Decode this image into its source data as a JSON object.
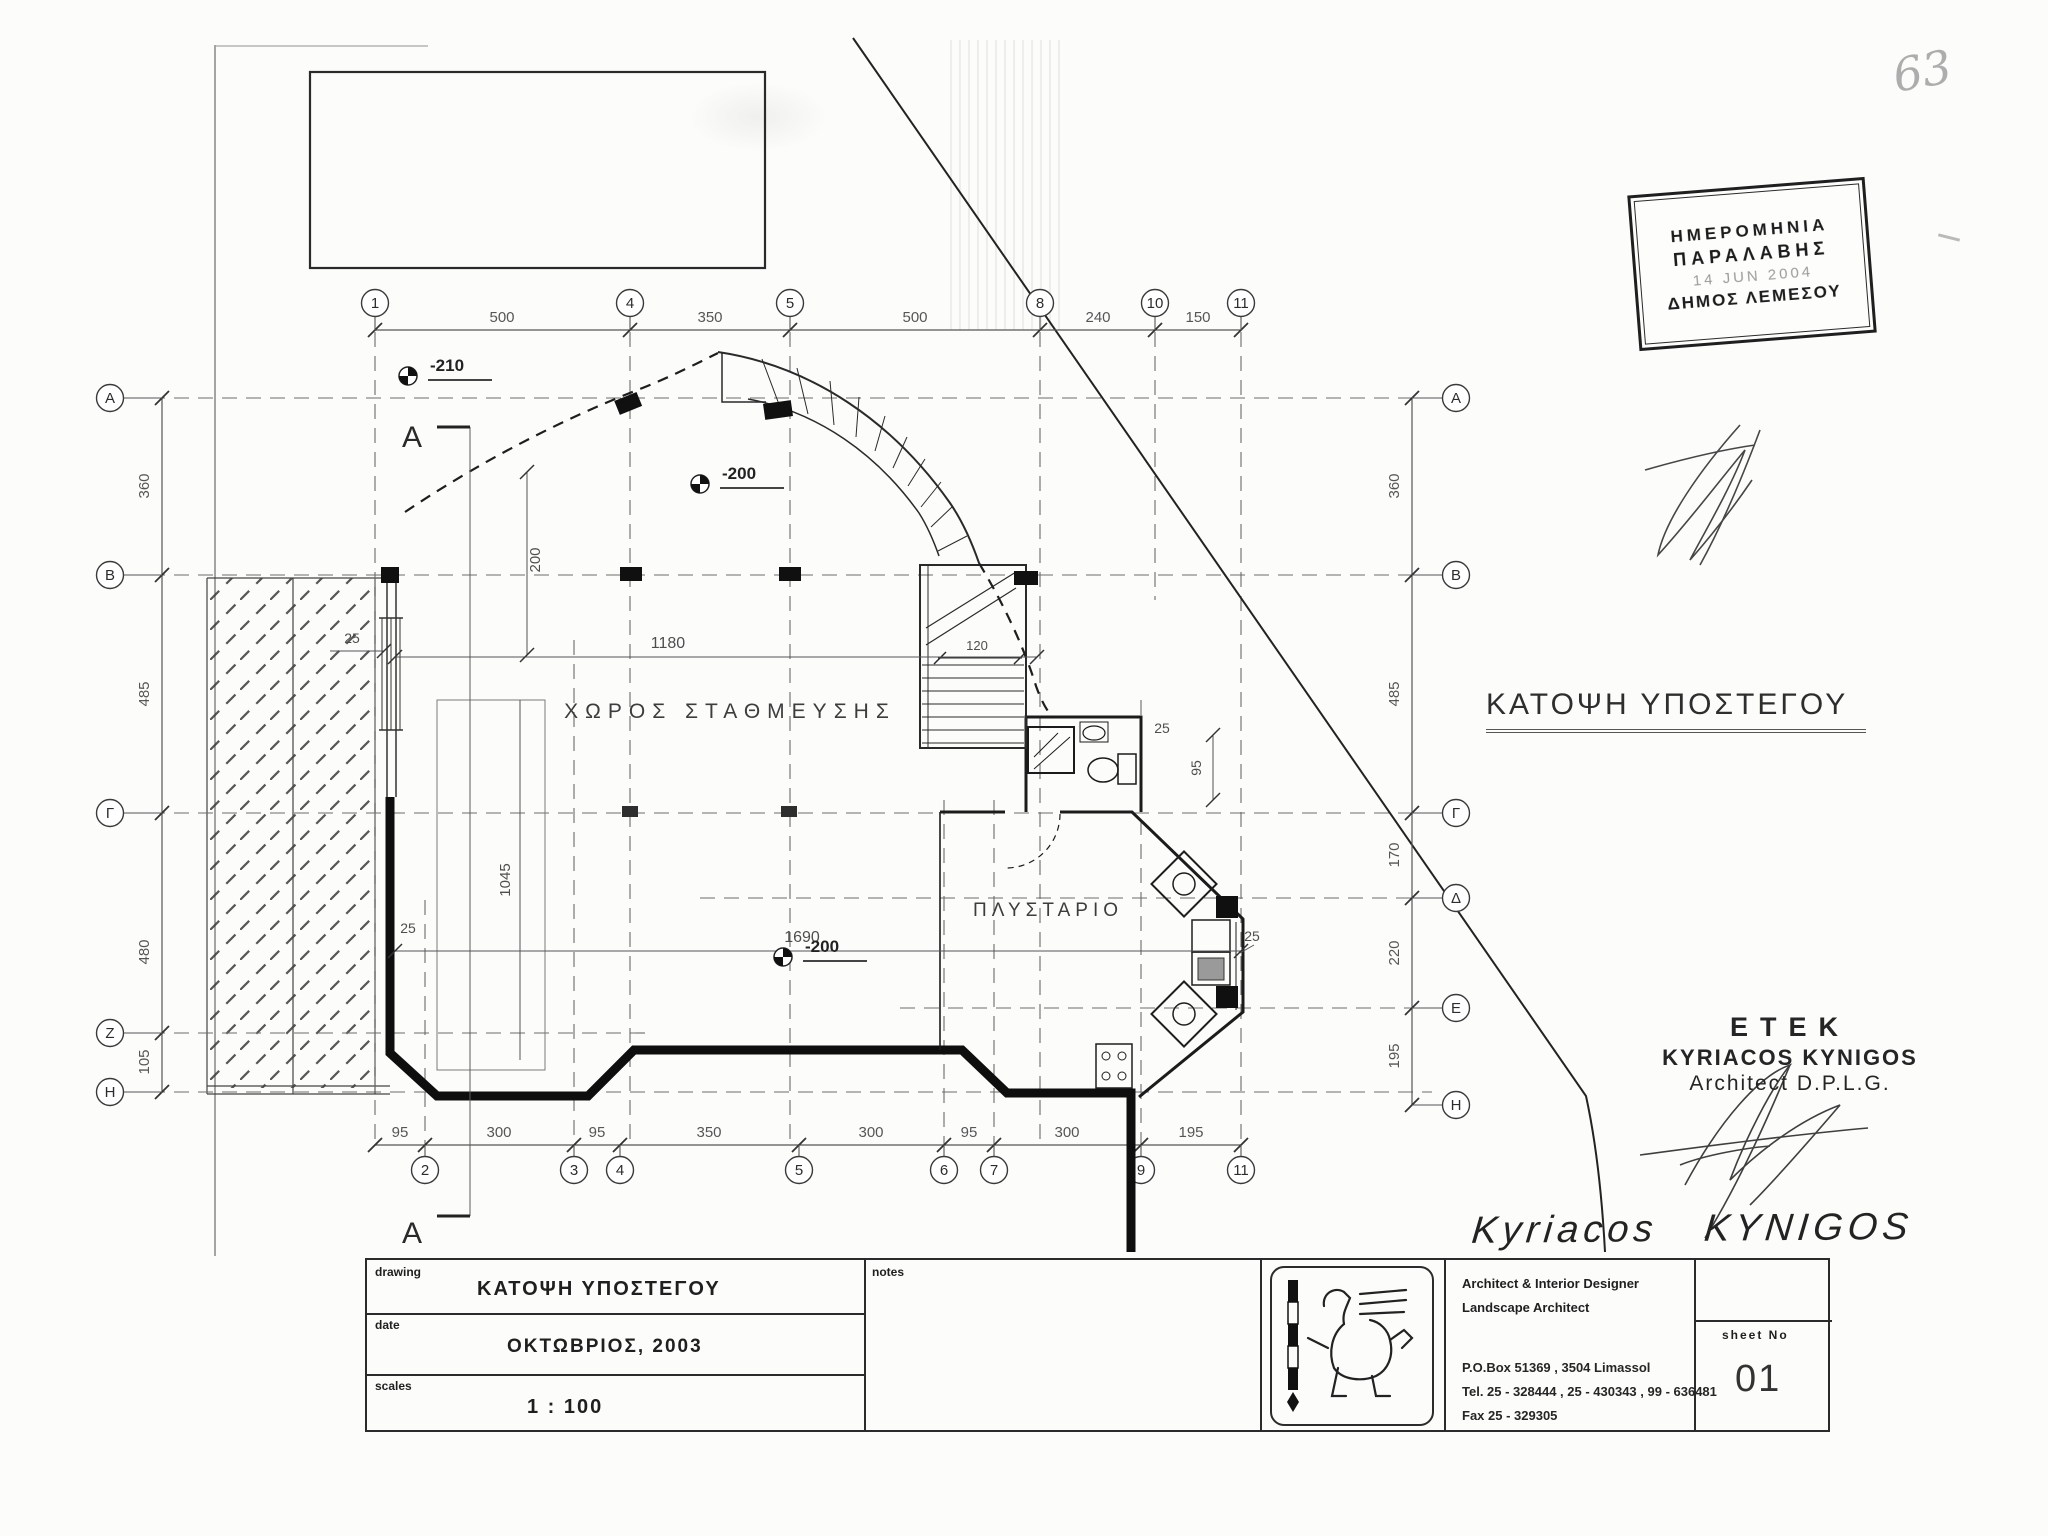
{
  "page": {
    "corner_number": "63"
  },
  "stamp": {
    "line1": "ΗΜΕΡΟΜΗΝΙΑ",
    "line2": "ΠΑΡΑΛΑΒΗΣ",
    "line3": "14 JUN 2004",
    "line4": "ΔΗΜΟΣ ΛΕΜΕΣΟΥ"
  },
  "plan": {
    "title": "ΚΑΤΟΨΗ ΥΠΟΣΤΕΓΟΥ",
    "rooms": {
      "parking": "ΧΩΡΟΣ ΣΤΑΘΜΕΥΣΗΣ",
      "laundry": "ΠΛΥΣΤΑΡΙΟ"
    },
    "levels": [
      "-210",
      "-200",
      "-200"
    ],
    "section_label": "A",
    "grid_top": [
      "1",
      "4",
      "5",
      "8",
      "10",
      "11"
    ],
    "grid_bottom": [
      "2",
      "3",
      "4",
      "5",
      "6",
      "7",
      "9",
      "11"
    ],
    "grid_left": [
      "Α",
      "Β",
      "Γ",
      "Ζ",
      "Η"
    ],
    "grid_right": [
      "Α",
      "Β",
      "Γ",
      "Δ",
      "Ε",
      "Η"
    ],
    "dims_top": [
      "500",
      "350",
      "500",
      "240",
      "150"
    ],
    "dims_bottom": [
      "95",
      "300",
      "95",
      "350",
      "300",
      "95",
      "300",
      "195"
    ],
    "dims_left": [
      "360",
      "485",
      "480",
      "105"
    ],
    "dims_right": [
      "360",
      "485",
      "170",
      "220",
      "195"
    ],
    "dims_inner": {
      "w1180": "1180",
      "w1690": "1690",
      "stair120": "120",
      "v200": "200",
      "v1045": "1045",
      "t25a": "25",
      "t25b": "25",
      "t25c": "25",
      "t25d": "25",
      "v95": "95"
    }
  },
  "signature_block": {
    "org": "ΕΤΕΚ",
    "name": "KYRIACOS KYNIGOS",
    "role": "Architect D.P.L.G.",
    "written_name": "Kyriacos   KYNIGOS"
  },
  "titleblock": {
    "drawing_label": "drawing",
    "drawing_value": "ΚΑΤΟΨΗ ΥΠΟΣΤΕΓΟΥ",
    "date_label": "date",
    "date_value": "ΟΚΤΩΒΡΙΟΣ, 2003",
    "scales_label": "scales",
    "scales_value": "1 : 100",
    "notes_label": "notes",
    "office_line1": "Architect & Interior Designer",
    "office_line2": "Landscape Architect",
    "address": "P.O.Box 51369 , 3504 Limassol",
    "tel": "Tel. 25 - 328444 , 25 - 430343 , 99 - 636481",
    "fax": "Fax  25 - 329305",
    "sheet_label": "sheet  No",
    "sheet_value": "01"
  }
}
